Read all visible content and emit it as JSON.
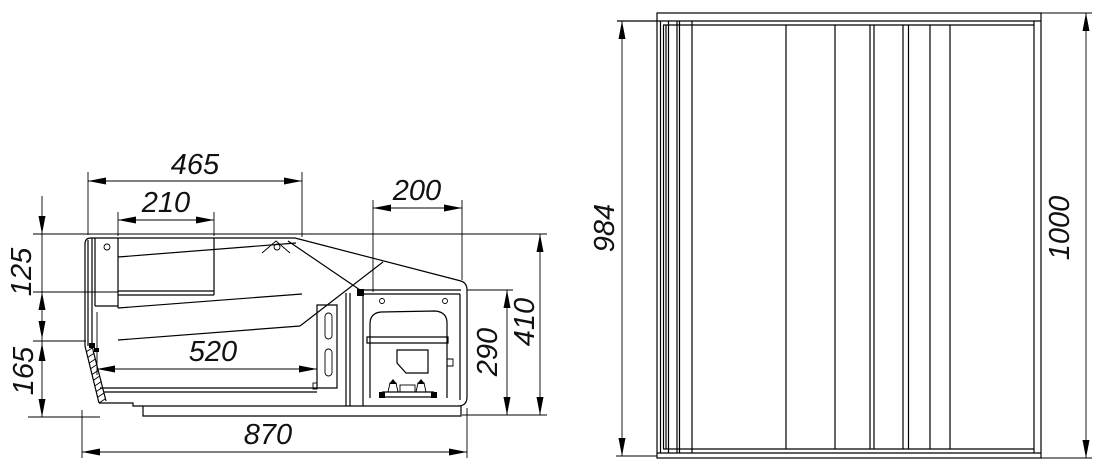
{
  "background": "#ffffff",
  "line_color": "#000000",
  "dimensions": {
    "canopy_width": "465",
    "lid_inner_width": "210",
    "machine_bay_width": "200",
    "front_upper_height": "125",
    "front_lower_height": "165",
    "well_width": "520",
    "overall_width": "870",
    "bay_height": "290",
    "body_height": "410",
    "inner_height": "984",
    "overall_height": "1000"
  }
}
